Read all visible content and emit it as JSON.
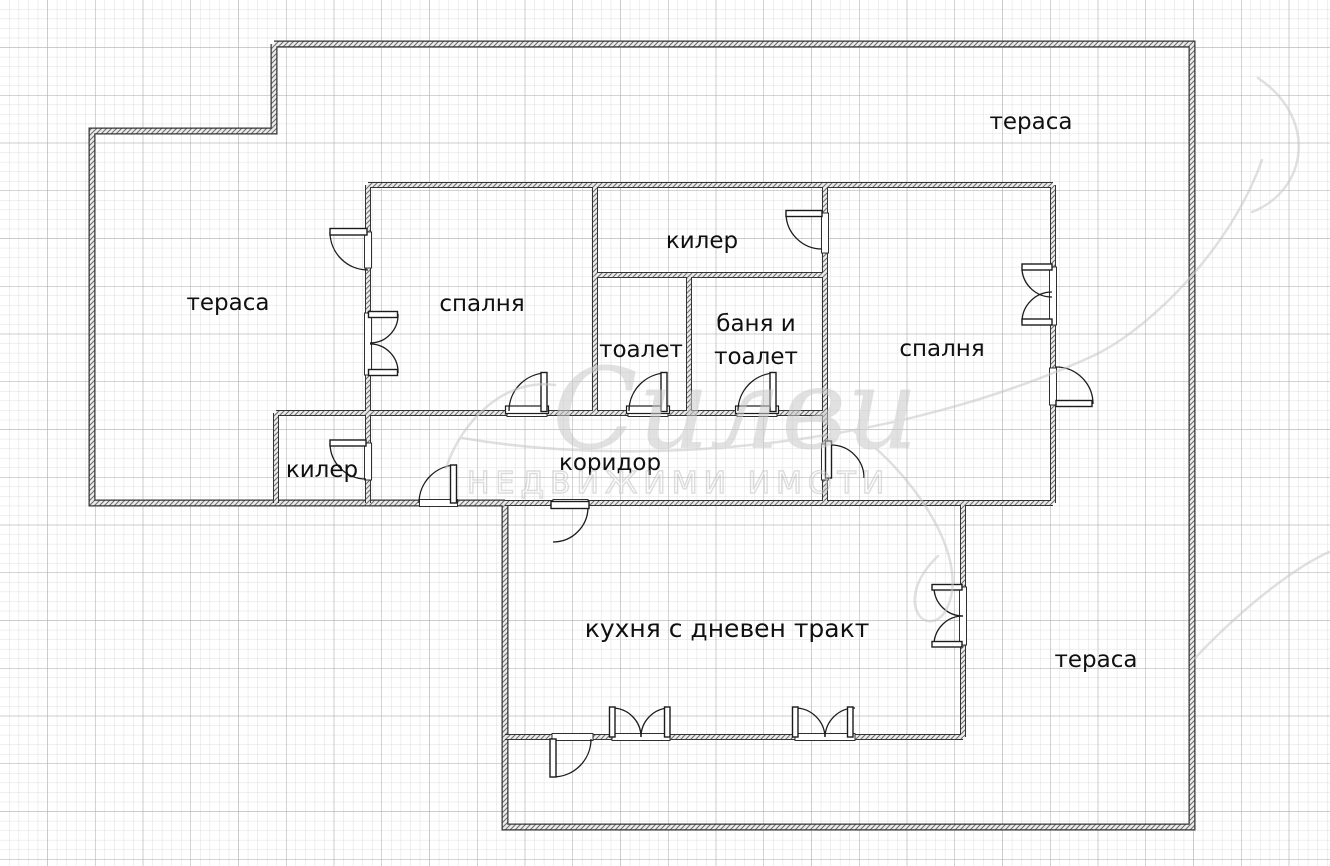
{
  "page": {
    "background": "#ffffff",
    "grid_minor_color": "#dedede",
    "grid_major_color": "#a9a9a9",
    "wall_color": "#343434"
  },
  "rooms": {
    "terrace_top": "тераса",
    "terrace_left": "тераса",
    "terrace_bottom": "тераса",
    "bedroom_left": "спалня",
    "bedroom_right": "спалня",
    "closet_top": "килер",
    "closet_left": "килер",
    "toilet": "тоалет",
    "bath_line1": "баня и",
    "bath_line2": "тоалет",
    "corridor": "коридор",
    "kitchen": "кухня с дневен тракт"
  },
  "watermark": {
    "script_text": "Силви",
    "caps_text": "НЕДВИЖИМИ ИМОТИ"
  }
}
